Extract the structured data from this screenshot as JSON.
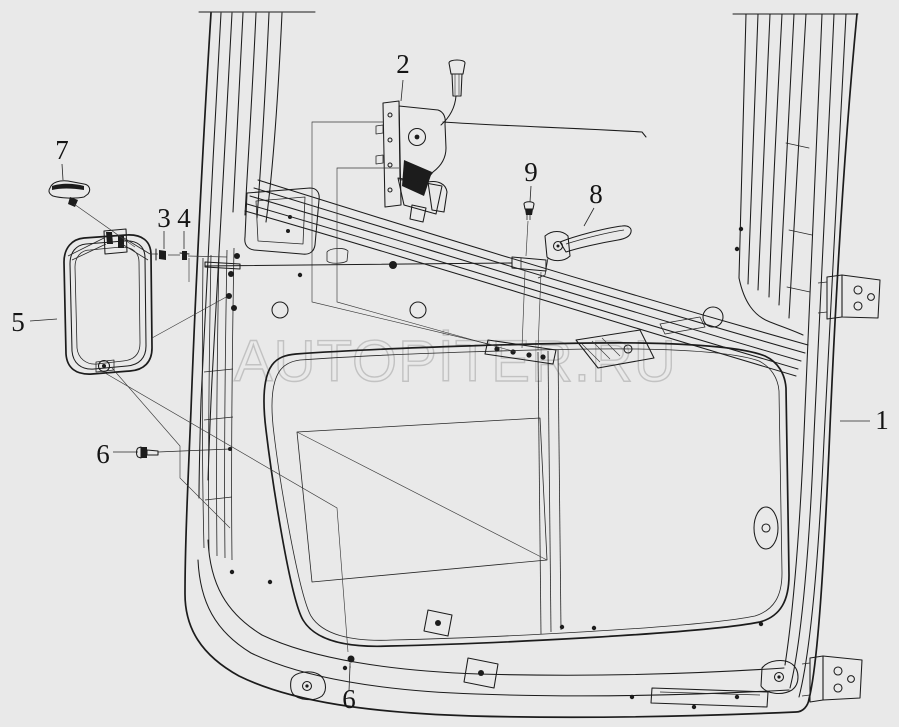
{
  "page": {
    "background_color": "#e9e9e9"
  },
  "watermark": {
    "text": "AUTOPİTER.RU",
    "color": "#c2c2c2"
  },
  "drawing": {
    "line_color": "#1c1c1c",
    "subject": "truck cab door assembly parts diagram"
  },
  "callouts": [
    {
      "label": "1"
    },
    {
      "label": "2"
    },
    {
      "label": "3"
    },
    {
      "label": "4"
    },
    {
      "label": "5"
    },
    {
      "label": "6"
    },
    {
      "label": "6"
    },
    {
      "label": "7"
    },
    {
      "label": "8"
    },
    {
      "label": "9"
    }
  ]
}
